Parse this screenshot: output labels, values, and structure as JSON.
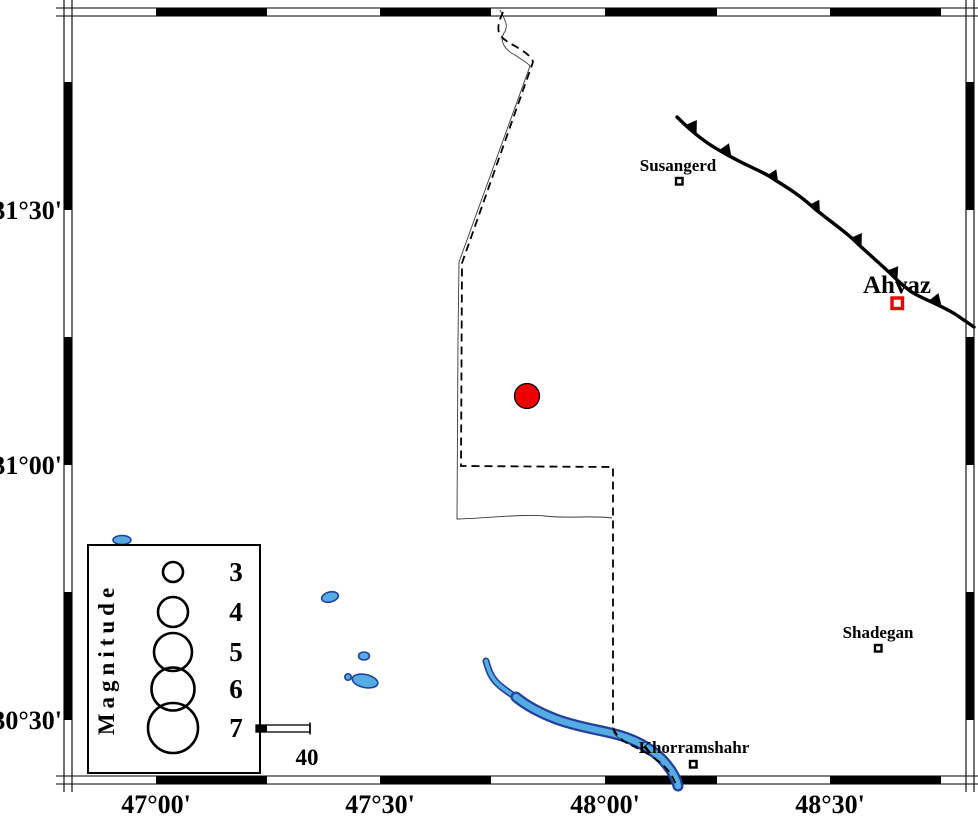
{
  "figure": {
    "type": "seismicity-map",
    "region_description": "Map with magnitude legend, epicenter, cities and thrust fault"
  },
  "axes": {
    "x_ticks": [
      {
        "label": "47°00'"
      },
      {
        "label": "47°30'"
      },
      {
        "label": "48°00'"
      },
      {
        "label": "48°30'"
      }
    ],
    "y_ticks": [
      {
        "label": "31°30'"
      },
      {
        "label": "31°00'"
      },
      {
        "label": "30°30'"
      }
    ]
  },
  "cities": [
    {
      "name": "Susangerd"
    },
    {
      "name": "Ahvaz"
    },
    {
      "name": "Shadegan"
    },
    {
      "name": "Khorramshahr"
    }
  ],
  "legend": {
    "title": "Magnitude",
    "entries": [
      {
        "label": "3"
      },
      {
        "label": "4"
      },
      {
        "label": "5"
      },
      {
        "label": "6"
      },
      {
        "label": "7"
      }
    ]
  },
  "scale_bar": {
    "label": "40"
  },
  "epicenter": {
    "color": "#ee0000"
  },
  "colors": {
    "water_fill": "#55ace2",
    "water_stroke": "#23409a",
    "fault": "#000000",
    "frame": "#000000",
    "ahvaz_marker": "#ee0000"
  }
}
